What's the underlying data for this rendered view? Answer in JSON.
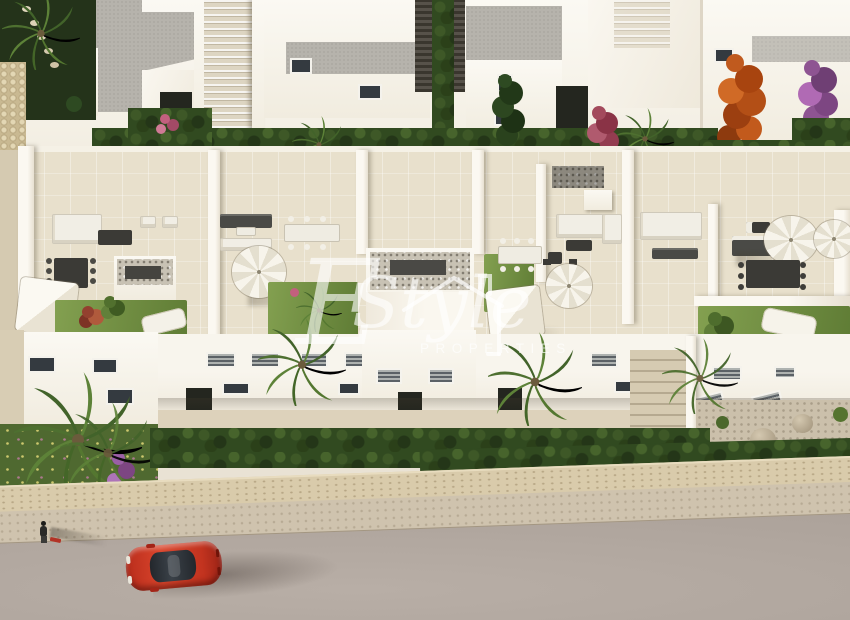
{
  "watermark": {
    "initial": "E",
    "script": "Style",
    "subtitle": "PROPERTIES",
    "icon": "house-roof-icon",
    "color": "#ffffff",
    "opacity": 0.62
  },
  "palette": {
    "wall_white": "#f6f2e9",
    "wall_shadow": "#ddd5c6",
    "roof_gray": "#b6b3ac",
    "terrace_floor": "#e8e0cc",
    "lawn_green": "#6f8c3e",
    "hedge_green": "#314a20",
    "palm_green": "#4e7030",
    "orange_tree": "#bf561e",
    "bougainvillea": "#8e5492",
    "pink_flowers": "#c2607e",
    "road_gray": "#b2a8a0",
    "sidewalk_beige": "#cfc3ae",
    "stone_wall": "#d9cbab",
    "car_red": "#c63a24",
    "furniture_dark": "#4a4a46",
    "parasol_white": "#f4f0e7"
  }
}
